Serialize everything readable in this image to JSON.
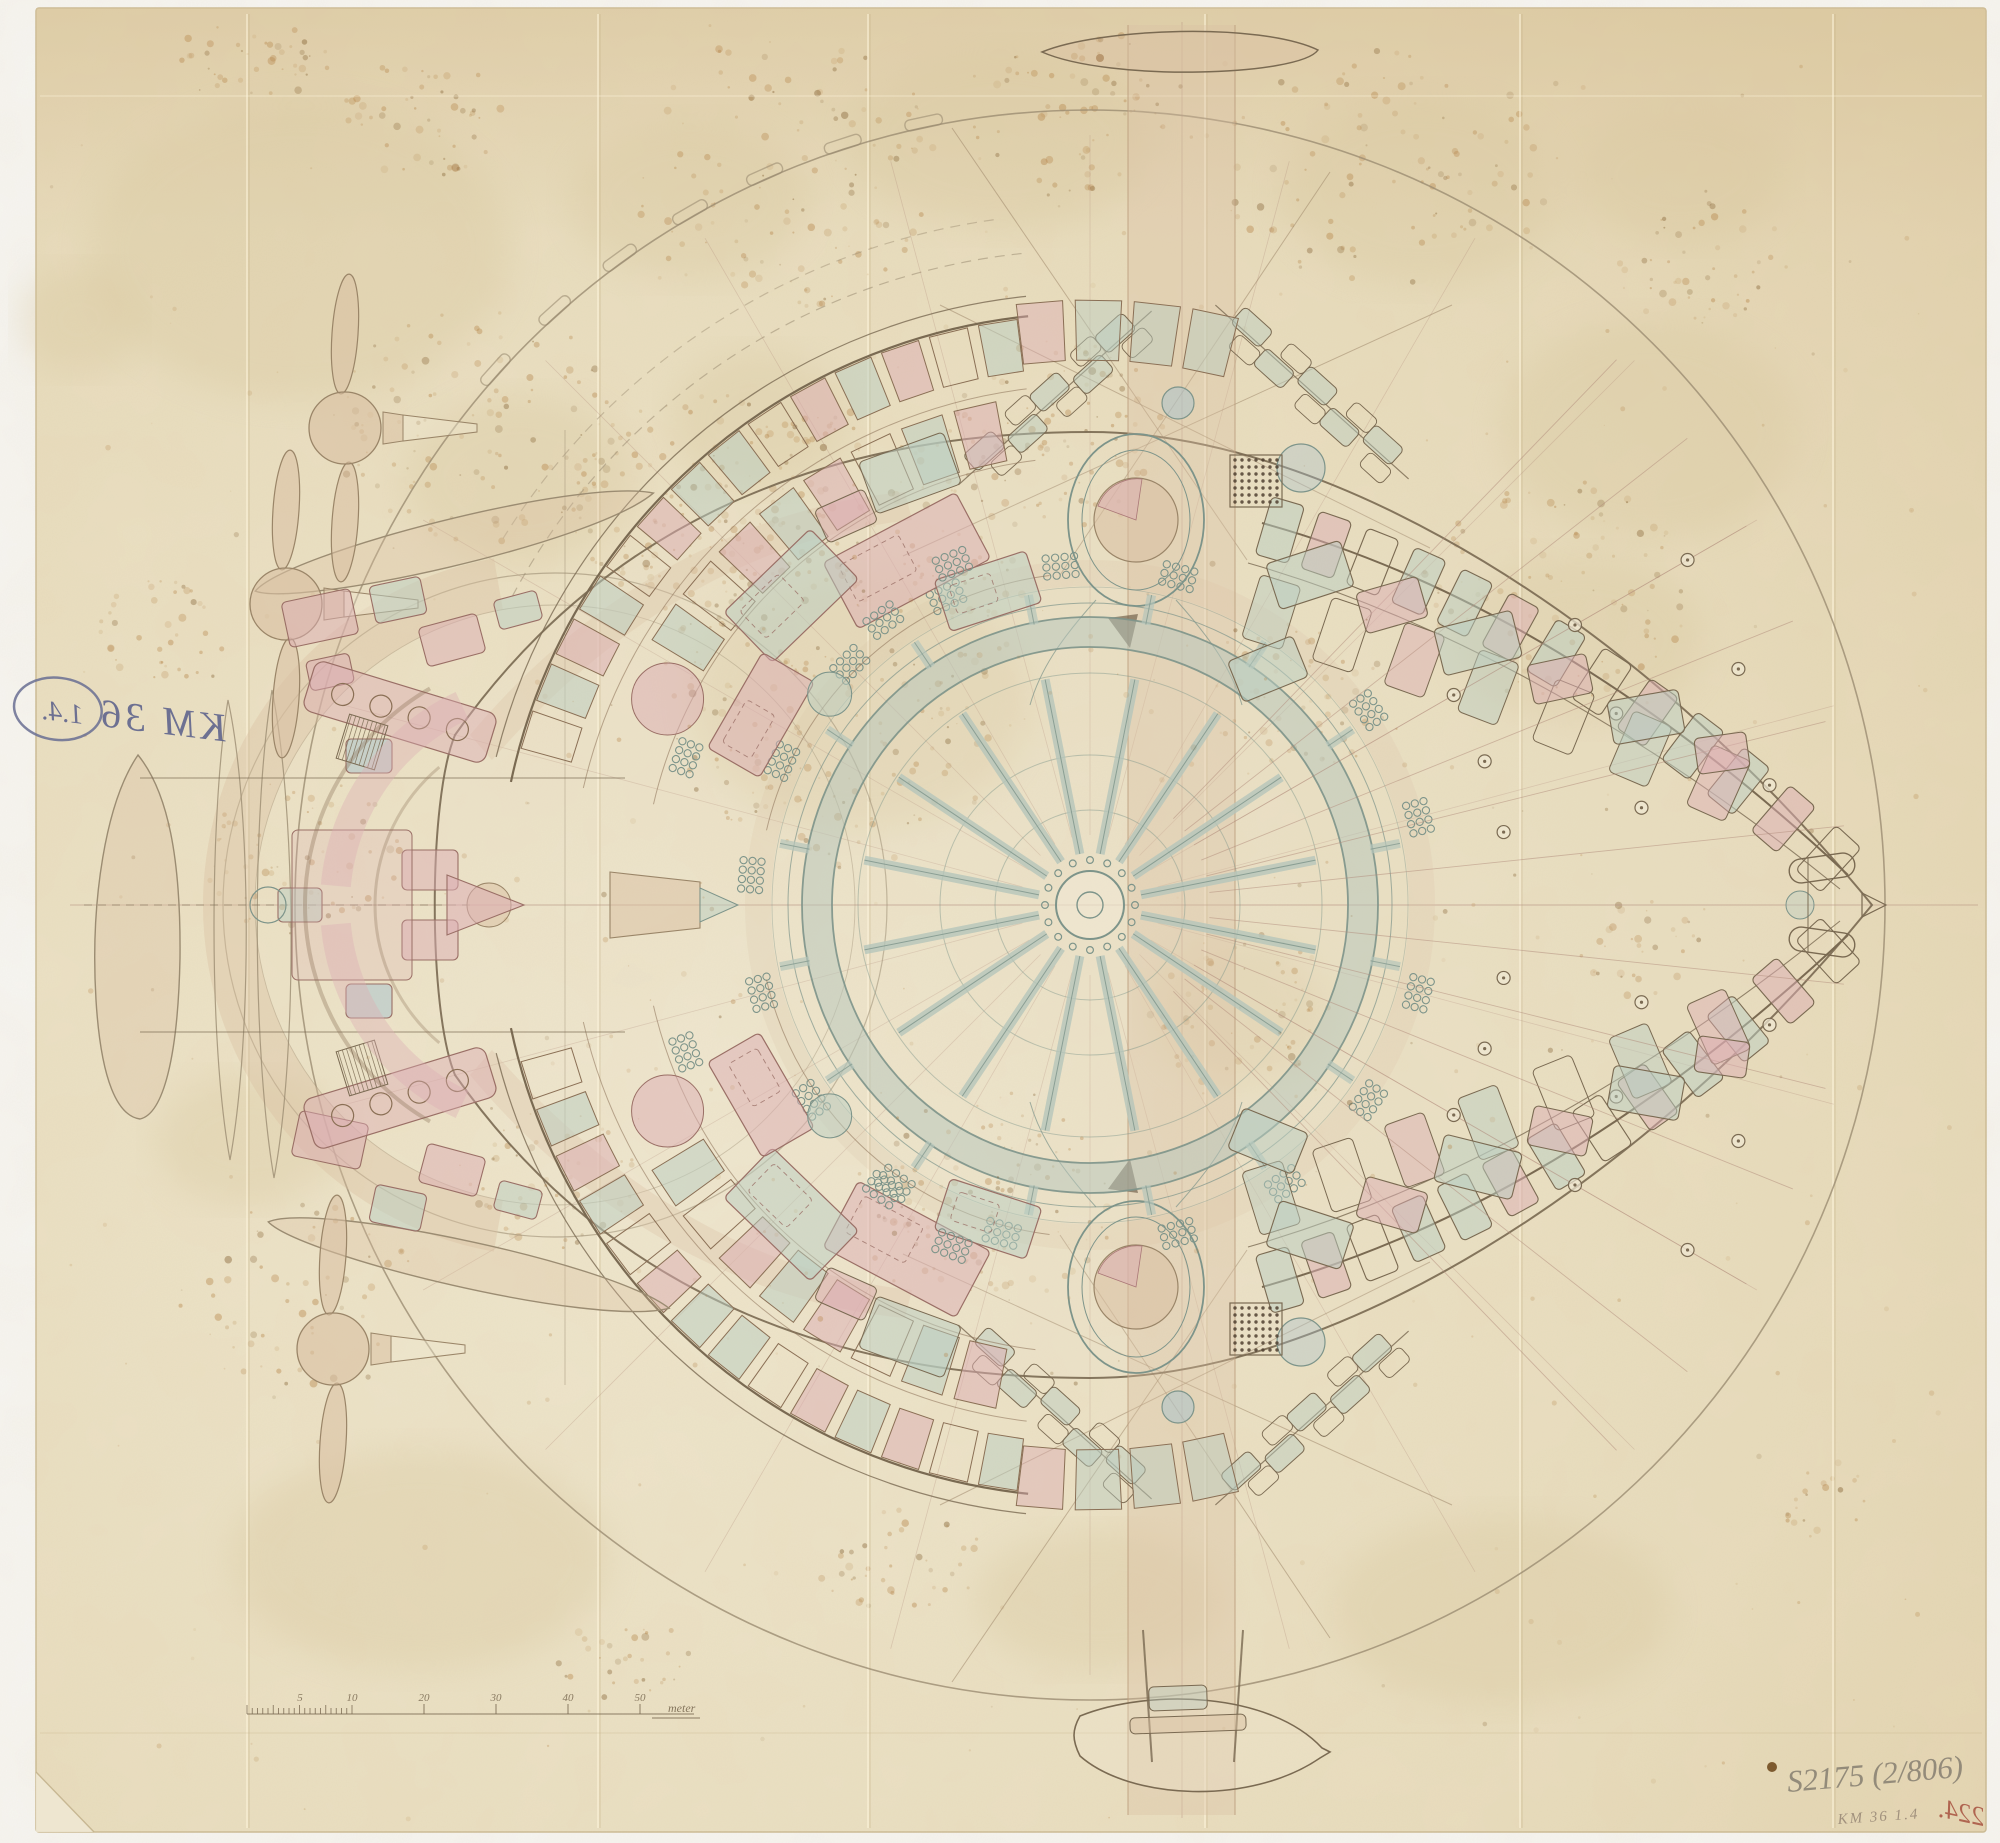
{
  "document": {
    "kind": "hand-drawn technical plan on aged paper",
    "annotations": {
      "stamp_text": "KM 36",
      "stamp_number": "1.4.",
      "inventory_inscription": "S2175 (2/806)",
      "inventory_sub": "KM 36 1.4",
      "corner_number": "224.",
      "scale": {
        "unit_label": "meter",
        "tick_labels": [
          "5",
          "10",
          "20",
          "30",
          "40",
          "50"
        ]
      }
    },
    "palette": {
      "paper": "#e8dcbe",
      "paper_light": "#f0e8d3",
      "paper_dark": "#dcc9a1",
      "stain": "#b5854a",
      "stain_dark": "#7e5a2b",
      "water_stain": "#d8c79e",
      "ink": "#7a6a52",
      "faint": "#9b8c72",
      "red_line": "#b08a7a",
      "teal": "#7d948a",
      "teal_light": "#b6c6bb",
      "pink": "#dcaeb4",
      "green": "#b9cdc2",
      "blue": "#a6c1cd",
      "tan": "#d9c0a2",
      "tan_deep": "#cfa87e",
      "blue_pencil": "#585e8a",
      "pencil_gray": "#8b8374",
      "red_number": "#a85240"
    }
  }
}
